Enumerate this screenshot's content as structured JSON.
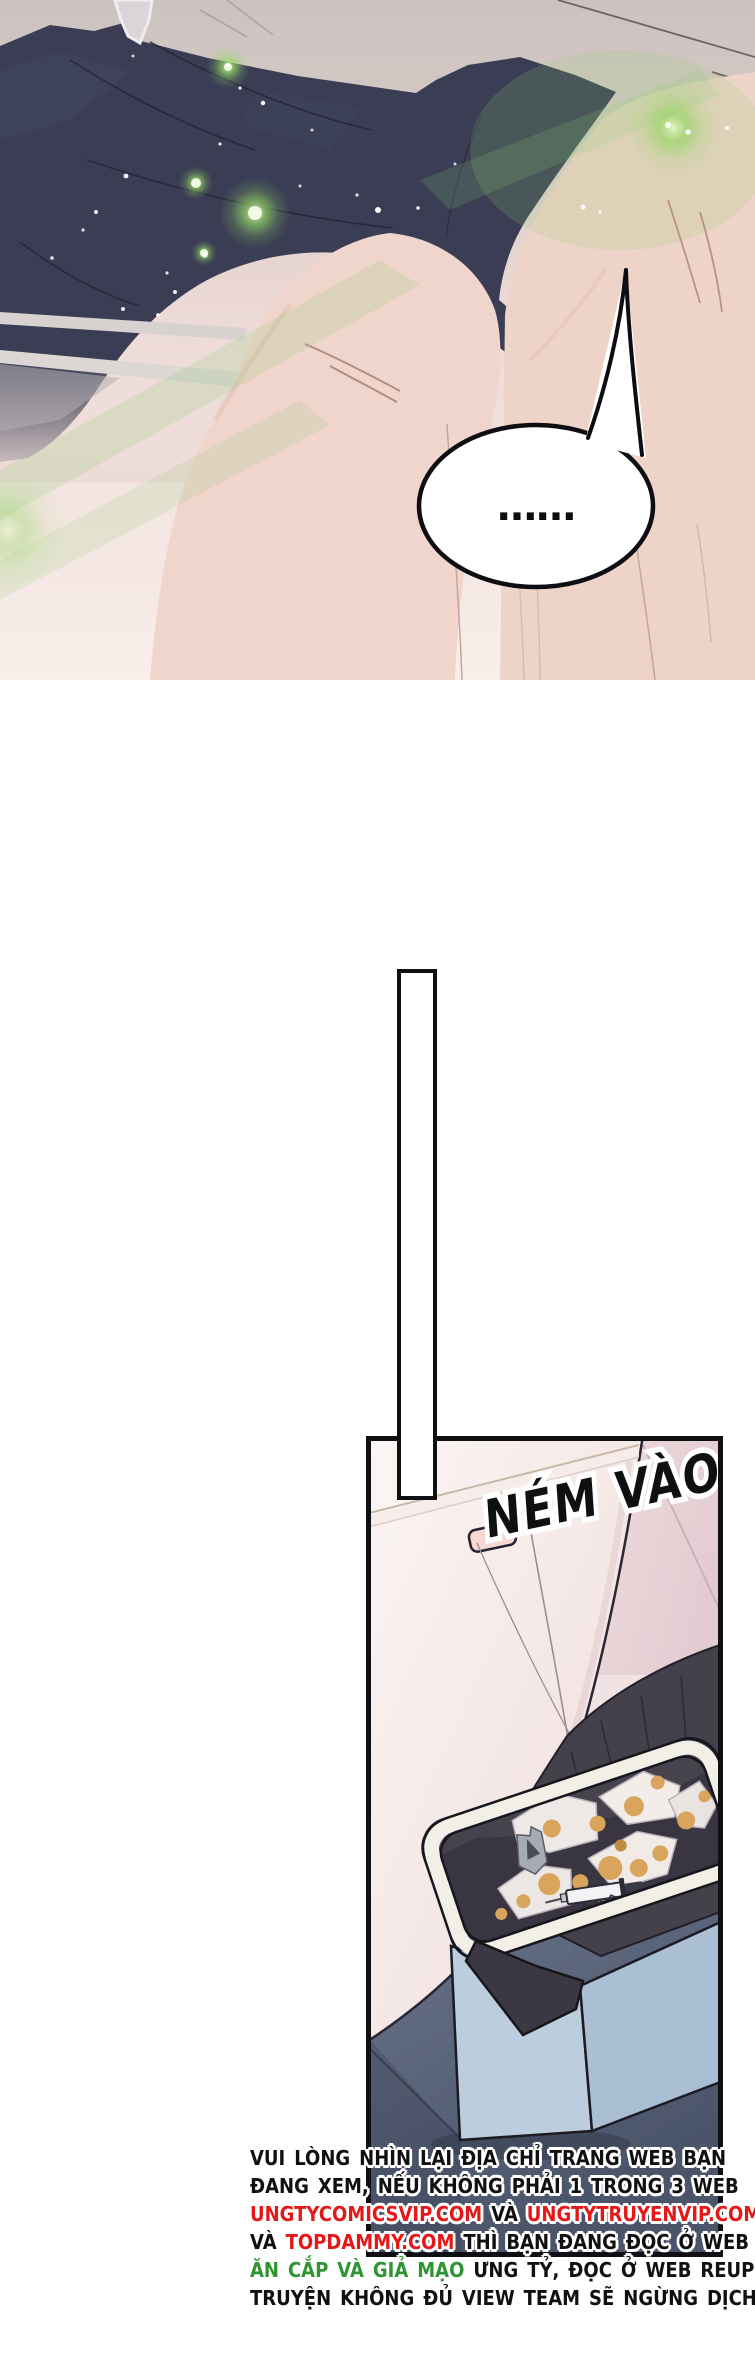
{
  "colors": {
    "panel_border": "#0f0f14",
    "navy_blanket": "#3a3d54",
    "skin": "#eed3c9",
    "green_glow": "#8fd663",
    "background_warm": "#cdc5c2",
    "tank_white": "#f8f1ef",
    "bin_blue_front": "#bccddd",
    "bin_blue_side": "#aabfd3",
    "trash_bag": "#44414b",
    "bin_rim": "#f2efe7",
    "carpet": "#78819a",
    "stain_orange": "#d9a55c",
    "warning_black": "#101010",
    "warning_red": "#e51717",
    "warning_green": "#2f9432"
  },
  "top_panel": {
    "speech_bubble_text": "……"
  },
  "trash_panel": {
    "sfx_text": "NÉM VÀO"
  },
  "warning": {
    "lines": [
      {
        "segments": [
          {
            "text": "VUI LÒNG NHÌN LẠI ĐỊA CHỈ TRANG WEB BẠN",
            "color": "#101010"
          }
        ]
      },
      {
        "segments": [
          {
            "text": "ĐANG XEM, NẾU KHÔNG PHẢI 1 TRONG 3 WEB",
            "color": "#101010"
          }
        ]
      },
      {
        "segments": [
          {
            "text": "UNGTYCOMICSVIP.COM",
            "color": "#e51717"
          },
          {
            "text": " VÀ ",
            "color": "#101010"
          },
          {
            "text": "UNGTYTRUYENVIP.COM",
            "color": "#e51717"
          }
        ]
      },
      {
        "segments": [
          {
            "text": "VÀ ",
            "color": "#101010"
          },
          {
            "text": "TOPDAMMY.COM",
            "color": "#e51717"
          },
          {
            "text": " THÌ BẠN ĐANG ĐỌC Ở WEB",
            "color": "#101010"
          }
        ]
      },
      {
        "segments": [
          {
            "text": "ĂN CẮP VÀ GIẢ MẠO",
            "color": "#2f9432"
          },
          {
            "text": " ƯNG TỶ, ĐỌC Ở WEB REUP",
            "color": "#101010"
          }
        ]
      },
      {
        "segments": [
          {
            "text": "TRUYỆN KHÔNG ĐỦ VIEW TEAM SẼ NGỪNG DỊCH.",
            "color": "#101010"
          }
        ]
      }
    ]
  }
}
